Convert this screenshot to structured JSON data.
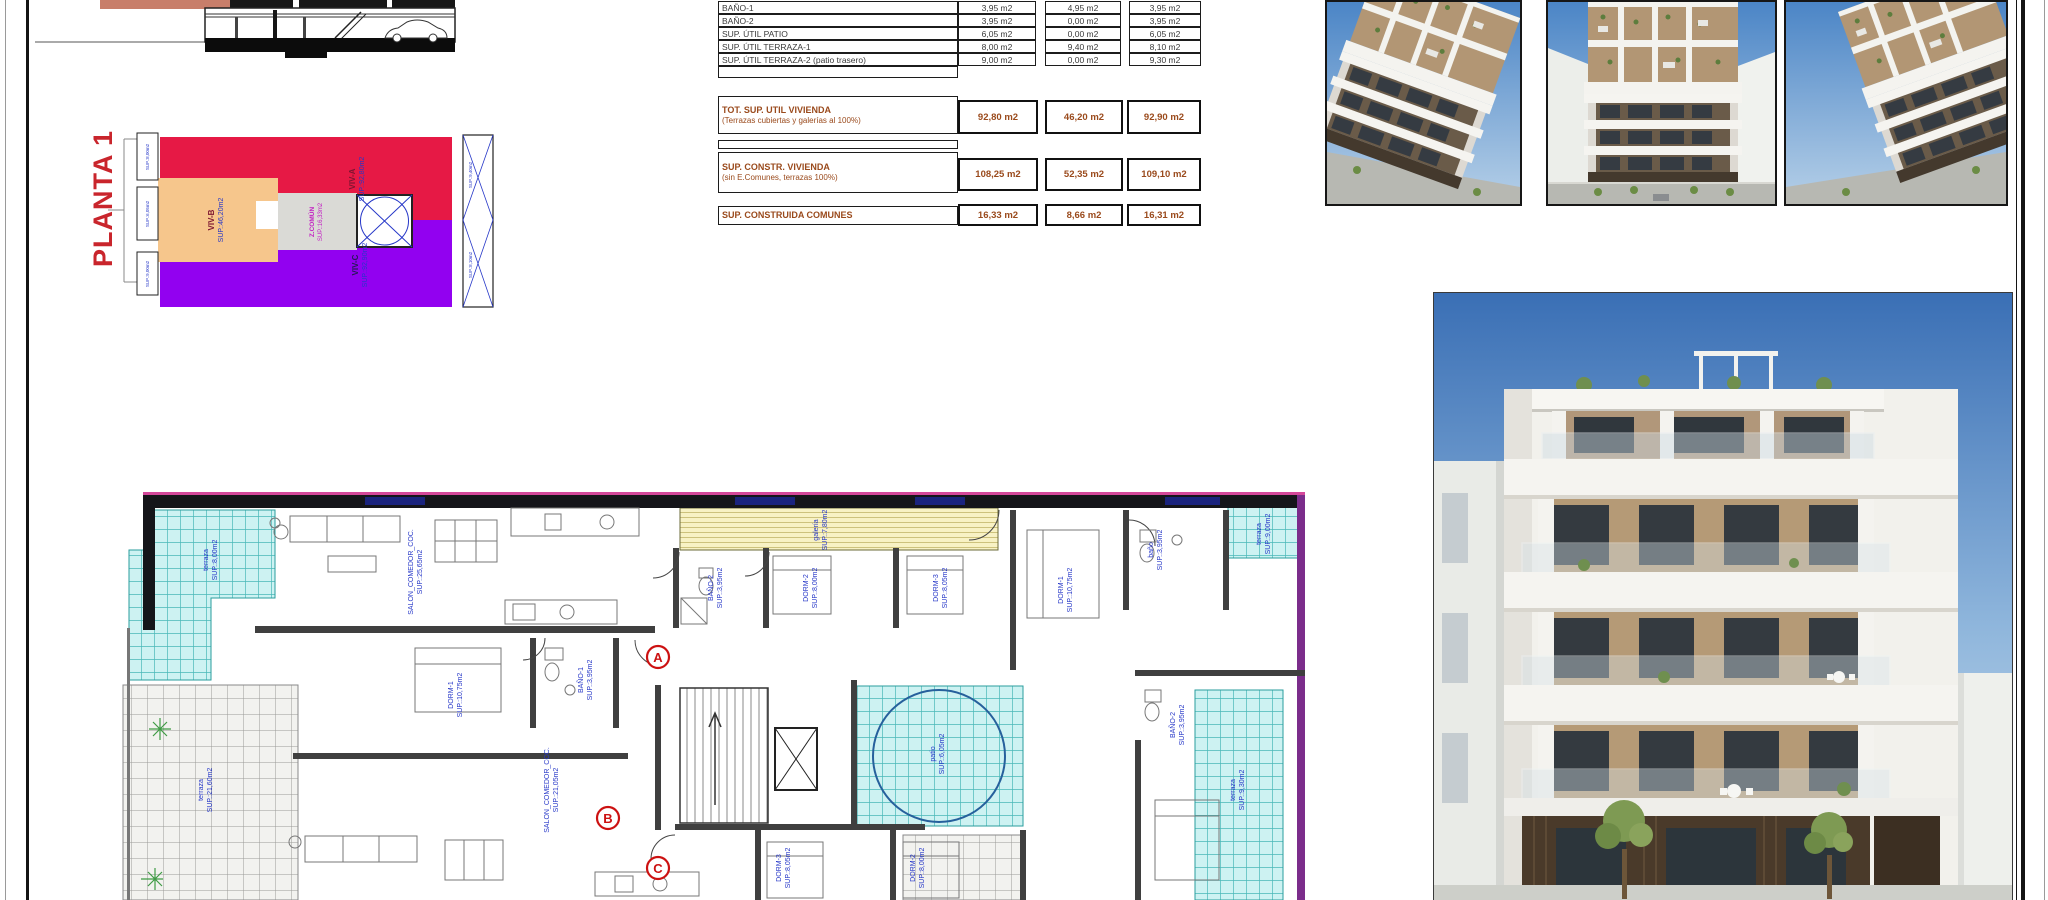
{
  "sheet": {
    "background": "#ffffff",
    "border_color": "#141414"
  },
  "colors": {
    "planta_title_red": "#c9252c",
    "viv_a_red": "#e61945",
    "viv_b_orange": "#f6c68c",
    "viv_c_purple": "#9201f0",
    "z_comun_gray": "#dadad6",
    "label_blue": "#2637c8",
    "label_magenta": "#c21ec2",
    "marker_red": "#cc1111",
    "table_summary_brown": "#9a4a1c",
    "terrace_cyan": "#cdf2f2",
    "gallery_yellow": "#f8f2c4",
    "sky_blue": "#3a6fb5"
  },
  "planta1": {
    "title": "PLANTA 1",
    "units": [
      {
        "name": "VIV-A",
        "sup": "SUP.:92,80m2"
      },
      {
        "name": "VIV-B",
        "sup": "SUP.:46,20m2"
      },
      {
        "name": "VIV-C",
        "sup": "SUP.:92,90m2"
      },
      {
        "name": "Z.COMÚN",
        "sup": "SUP.:16,33m2"
      }
    ],
    "edge_labels": [
      "SUP.:8,00m2",
      "SUP.:6,05m2",
      "SUP.:9,00m2"
    ],
    "stair_labels": [
      "SUP.:9,40m2",
      "SUP.:8,10m2"
    ]
  },
  "area_table": {
    "rows": [
      {
        "label": "BAÑO-1",
        "v": [
          "3,95 m2",
          "4,95 m2",
          "3,95 m2"
        ]
      },
      {
        "label": "BAÑO-2",
        "v": [
          "3,95 m2",
          "0,00 m2",
          "3,95 m2"
        ]
      },
      {
        "label": "SUP. ÚTIL PATIO",
        "v": [
          "6,05 m2",
          "0,00 m2",
          "6,05 m2"
        ]
      },
      {
        "label": "SUP. ÚTIL TERRAZA-1",
        "v": [
          "8,00 m2",
          "9,40 m2",
          "8,10 m2"
        ]
      },
      {
        "label": "SUP. ÚTIL TERRAZA-2 (patio trasero)",
        "v": [
          "9,00 m2",
          "0,00 m2",
          "9,30 m2"
        ]
      }
    ],
    "summaries": [
      {
        "label": "TOT. SUP. UTIL VIVIENDA",
        "sub": "(Terrazas cubiertas y galerías al 100%)",
        "v": [
          "92,80 m2",
          "46,20 m2",
          "92,90 m2"
        ]
      },
      {
        "label": "SUP. CONSTR. VIVIENDA",
        "sub": "(sin E.Comunes, terrazas 100%)",
        "v": [
          "108,25 m2",
          "52,35 m2",
          "109,10 m2"
        ]
      },
      {
        "label": "SUP. CONSTRUIDA COMUNES",
        "sub": "",
        "v": [
          "16,33 m2",
          "8,66 m2",
          "16,31 m2"
        ]
      }
    ]
  },
  "floor_plan": {
    "markers": [
      "A",
      "B",
      "C"
    ],
    "rooms": [
      {
        "n": "terraza",
        "s": "SUP.:8,00m2"
      },
      {
        "n": "SALON_COMEDOR_COC.",
        "s": "SUP.:25,65m2"
      },
      {
        "n": "BAÑO-2",
        "s": "SUP.:3,95m2"
      },
      {
        "n": "DORM-2",
        "s": "SUP.:8,00m2"
      },
      {
        "n": "DORM-3",
        "s": "SUP.:8,05m2"
      },
      {
        "n": "galería",
        "s": "SUP.:7,80m2"
      },
      {
        "n": "baño",
        "s": "SUP.:3,95m2"
      },
      {
        "n": "DORM-1",
        "s": "SUP.:10,75m2"
      },
      {
        "n": "terraza",
        "s": "SUP.:9,00m2"
      },
      {
        "n": "patio",
        "s": "SUP.:6,05m2"
      },
      {
        "n": "BAÑO-1",
        "s": "SUP.:3,95m2"
      },
      {
        "n": "DORM-1",
        "s": "SUP.:10,75m2"
      },
      {
        "n": "SALON_COMEDOR_COC.",
        "s": "SUP.:21,05m2"
      },
      {
        "n": "terraza",
        "s": "SUP.:21,60m2"
      },
      {
        "n": "DORM-3",
        "s": "SUP.:8,05m2"
      },
      {
        "n": "DORM-2",
        "s": "SUP.:8,00m2"
      },
      {
        "n": "terraza",
        "s": "SUP.:9,30m2"
      },
      {
        "n": "BAÑO-2",
        "s": "SUP.:3,95m2"
      }
    ]
  }
}
